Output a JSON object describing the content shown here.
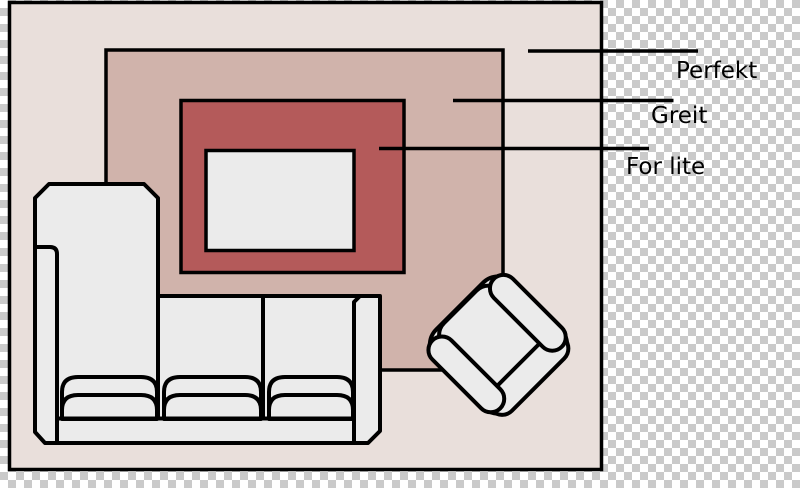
{
  "canvas": {
    "width": 800,
    "height": 488,
    "background": {
      "type": "transparency-checkerboard",
      "square_px": 8,
      "light": "#ffffff",
      "dark": "#cacaca"
    }
  },
  "colors": {
    "outline": "#000000",
    "room_floor": "#e9dfdb",
    "rug_large": "#d0b3ab",
    "rug_medium": "#b45a5a",
    "rug_small": "#ebebeb",
    "furniture": "#ebebeb",
    "label_text": "#000000"
  },
  "scene": {
    "description_items": [
      "room floor plan",
      "three nested rug sizes",
      "sofa with chaise",
      "armchair rotated 45 degrees"
    ]
  },
  "legend": {
    "labels": [
      {
        "id": "perfekt",
        "text": "Perfekt",
        "points_to": "large-rug"
      },
      {
        "id": "greit",
        "text": "Greit",
        "points_to": "medium-rug"
      },
      {
        "id": "for_lite",
        "text": "For lite",
        "points_to": "small-rug"
      }
    ]
  }
}
